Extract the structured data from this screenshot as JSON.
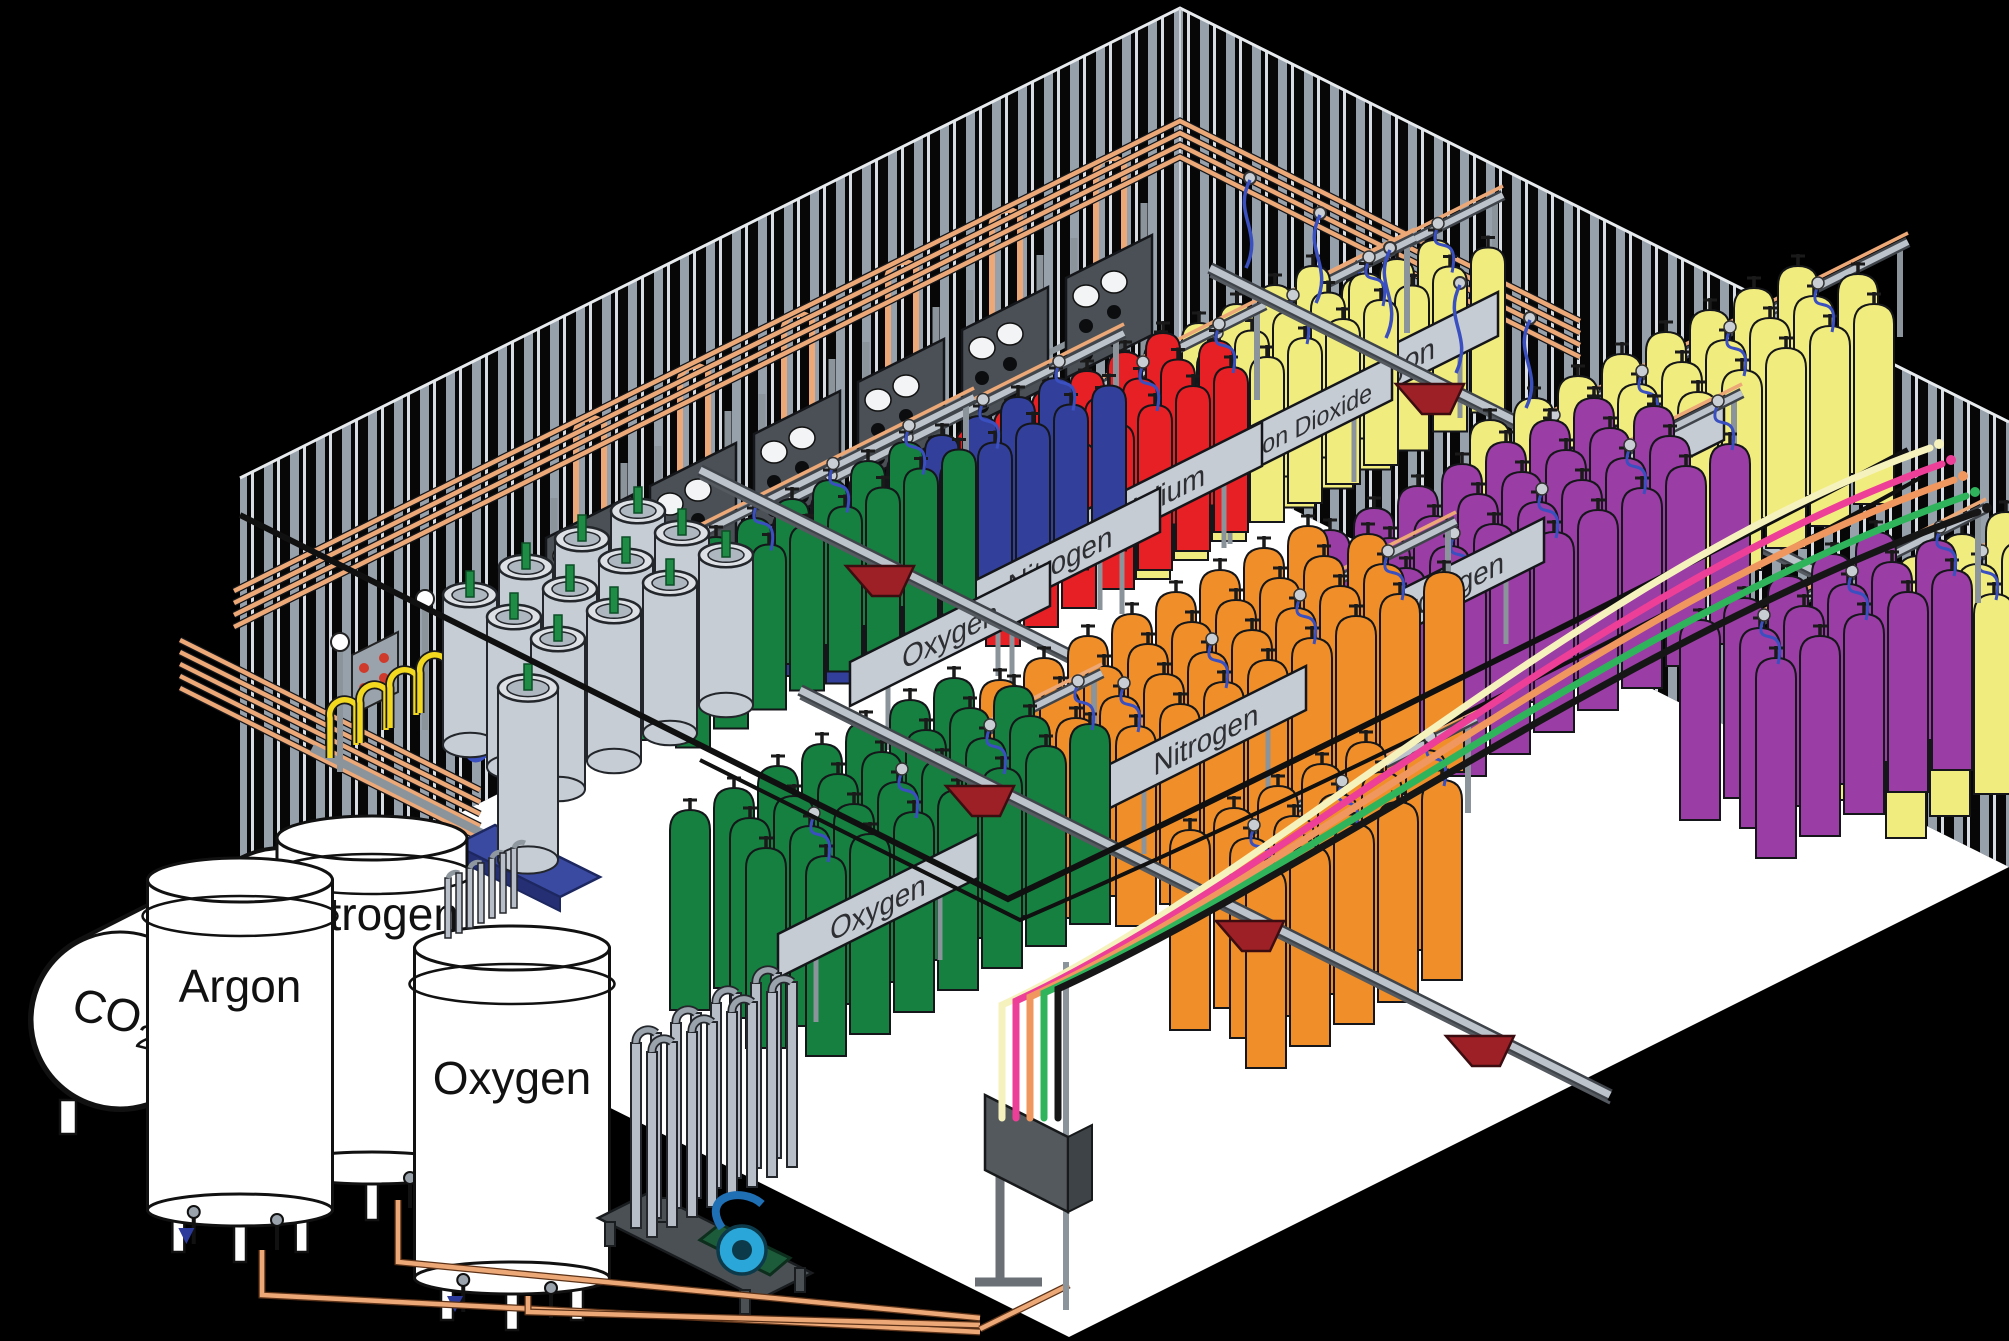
{
  "facility": {
    "bulk_tanks": {
      "co2": {
        "label_main": "CO",
        "label_sub": "2"
      },
      "argon": {
        "label": "Argon"
      },
      "nitrogen": {
        "label": "Nitrogen"
      },
      "oxygen": {
        "label": "Oxygen"
      }
    },
    "back_racks": [
      {
        "label": "Oxygen",
        "cylinder_color": "#15803f"
      },
      {
        "label": "Nitrogen",
        "cylinder_color": "#32409b"
      },
      {
        "label": "Helium",
        "cylinder_color": "#e62025"
      },
      {
        "label": "Carbon Dioxide",
        "cylinder_color": "#f1ec7e"
      },
      {
        "label": "Argon",
        "cylinder_color": "#f1ec7e"
      }
    ],
    "front_racks": [
      {
        "label": "Oxygen",
        "cylinder_color": "#15803f"
      },
      {
        "label": "Nitrogen",
        "cylinder_color": "#f08f2a"
      },
      {
        "label": "Hydrogen",
        "cylinder_color": "#9a3da4"
      },
      {
        "label": "Argon",
        "cylinder_color": "#f1ec7e"
      }
    ],
    "extra_groups": [
      {
        "cylinder_color": "#9a3da4"
      },
      {
        "cylinder_color": "#f08f2a"
      },
      {
        "cylinder_color": "#f1ec7e"
      }
    ],
    "dewars": {
      "color": "#c6cdd5",
      "rim_color": "#dde1e6",
      "stem_color": "#1e8c45"
    },
    "transfer_hoses": {
      "colors": [
        "#f6f2bd",
        "#ee3f98",
        "#f0975f",
        "#2fb45c",
        "#161616"
      ]
    },
    "palette": {
      "background": "#000000",
      "floor": "#ffffff",
      "wall_stripe": "#97a1ac",
      "wall_stripe_bright": "#d7dde2",
      "copper": "#eda878",
      "copper_dark": "#5c3318",
      "rail_light": "#bcc3cb",
      "rail_dark": "#3f444a",
      "sign": "#c6ccd4",
      "post": "#8b939b",
      "panel_dark": "#4a5055",
      "trolley_red": "#9c2026",
      "hose_blue": "#3a4fc0",
      "hose_yellow": "#f2d91f",
      "pallet_blue": "#3a4aa0",
      "pump_teal": "#2aa7d8",
      "pump_body": "#1d5c3a",
      "outline": "#14161a"
    }
  }
}
